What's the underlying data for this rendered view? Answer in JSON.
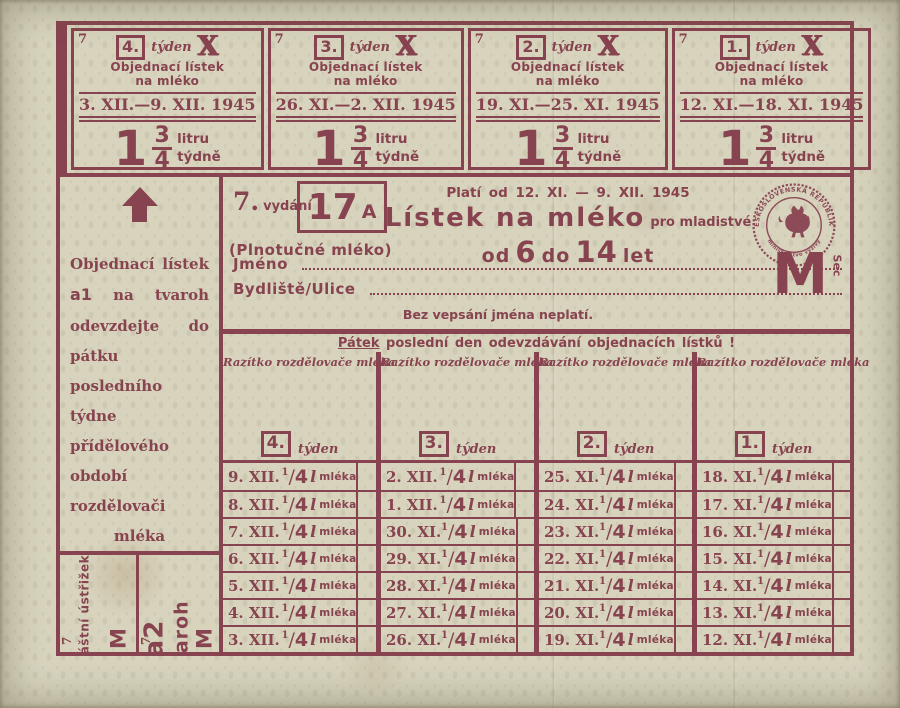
{
  "ink": "#87434f",
  "paper": "#d7d3bd",
  "marks": {
    "corner": "7",
    "cross": "X",
    "side_mark": "Sec"
  },
  "ration": {
    "sup": "1",
    "slash": "/",
    "den": "4",
    "unit": "l",
    "word": "mléka"
  },
  "stubs": {
    "b1": {
      "label": "Zvláštní ústřižek",
      "code": "b1",
      "letter": "M"
    },
    "a1": {
      "label": "Objednací lístek na",
      "code": "a1",
      "product": "tvaroh",
      "letter": "M"
    },
    "b2": {
      "code": "b2",
      "label": "Zvláštní ústřižek.",
      "letter": "M"
    },
    "a2": {
      "code": "a2",
      "product": "tvaroh",
      "letter": "M"
    }
  },
  "coupons": [
    {
      "week": "4.",
      "week_word": "týden",
      "line1": "Objednací lístek",
      "line2": "na mléko",
      "dates": "3. XII.—9. XII. 1945",
      "qty_int": "1",
      "qty_num": "3",
      "qty_den": "4",
      "unit1": "litru",
      "unit2": "týdně"
    },
    {
      "week": "3.",
      "week_word": "týden",
      "line1": "Objednací lístek",
      "line2": "na mléko",
      "dates": "26. XI.—2. XII. 1945",
      "qty_int": "1",
      "qty_num": "3",
      "qty_den": "4",
      "unit1": "litru",
      "unit2": "týdně"
    },
    {
      "week": "2.",
      "week_word": "týden",
      "line1": "Objednací lístek",
      "line2": "na mléko",
      "dates": "19. XI.—25. XI. 1945",
      "qty_int": "1",
      "qty_num": "3",
      "qty_den": "4",
      "unit1": "litru",
      "unit2": "týdně"
    },
    {
      "week": "1.",
      "week_word": "týden",
      "line1": "Objednací lístek",
      "line2": "na mléko",
      "dates": "12. XI.—18. XI. 1945",
      "qty_int": "1",
      "qty_num": "3",
      "qty_den": "4",
      "unit1": "litru",
      "unit2": "týdně"
    }
  ],
  "header": {
    "edition": "7.",
    "edition_word": "vydání",
    "number": "17",
    "number_suffix": "A",
    "subtitle": "(Plnotučné mléko)",
    "valid": "Platí od 12. XI. — 9. XII. 1945",
    "title": "Lístek na mléko",
    "title_small": "pro mladistvé",
    "age_pre": "od",
    "age_from": "6",
    "age_mid": "do",
    "age_to": "14",
    "age_post": "let",
    "big_letter": "M",
    "seal_top": "ČESKOSLOVENSKÁ REPUBLIKA",
    "seal_bottom": "ministerstvo výživy"
  },
  "form": {
    "name_label": "Jméno",
    "name_value": "",
    "address_label": "Bydliště/Ulice",
    "address_value": "",
    "note": "Bez vepsání jména neplatí."
  },
  "left_note": {
    "pre": "Objednací lístek ",
    "code": "a1",
    "post": " na tvaroh odevzdejte do pátku posledního týdne přídělového období rozdělovači mléka"
  },
  "deadline": {
    "lead": "Pátek",
    "rest": " poslední den odevzdávání objednacích lístků !"
  },
  "columns": [
    {
      "stamp_label": "Razítko rozdělovače mléka",
      "week": "4.",
      "week_word": "týden",
      "rows": [
        {
          "date": "9. XII."
        },
        {
          "date": "8. XII."
        },
        {
          "date": "7. XII."
        },
        {
          "date": "6. XII."
        },
        {
          "date": "5. XII."
        },
        {
          "date": "4. XII."
        },
        {
          "date": "3. XII."
        }
      ]
    },
    {
      "stamp_label": "Razítko rozdělovače mléka",
      "week": "3.",
      "week_word": "týden",
      "rows": [
        {
          "date": "2. XII."
        },
        {
          "date": "1. XII."
        },
        {
          "date": "30. XI."
        },
        {
          "date": "29. XI."
        },
        {
          "date": "28. XI."
        },
        {
          "date": "27. XI."
        },
        {
          "date": "26. XI."
        }
      ]
    },
    {
      "stamp_label": "Razítko rozdělovače mléka",
      "week": "2.",
      "week_word": "týden",
      "rows": [
        {
          "date": "25. XI."
        },
        {
          "date": "24. XI."
        },
        {
          "date": "23. XI."
        },
        {
          "date": "22. XI."
        },
        {
          "date": "21. XI."
        },
        {
          "date": "20. XI."
        },
        {
          "date": "19. XI."
        }
      ]
    },
    {
      "stamp_label": "Razítko rozdělovače mléka",
      "week": "1.",
      "week_word": "týden",
      "rows": [
        {
          "date": "18. XI."
        },
        {
          "date": "17. XI."
        },
        {
          "date": "16. XI."
        },
        {
          "date": "15. XI."
        },
        {
          "date": "14. XI."
        },
        {
          "date": "13. XI."
        },
        {
          "date": "12. XI."
        }
      ]
    }
  ]
}
